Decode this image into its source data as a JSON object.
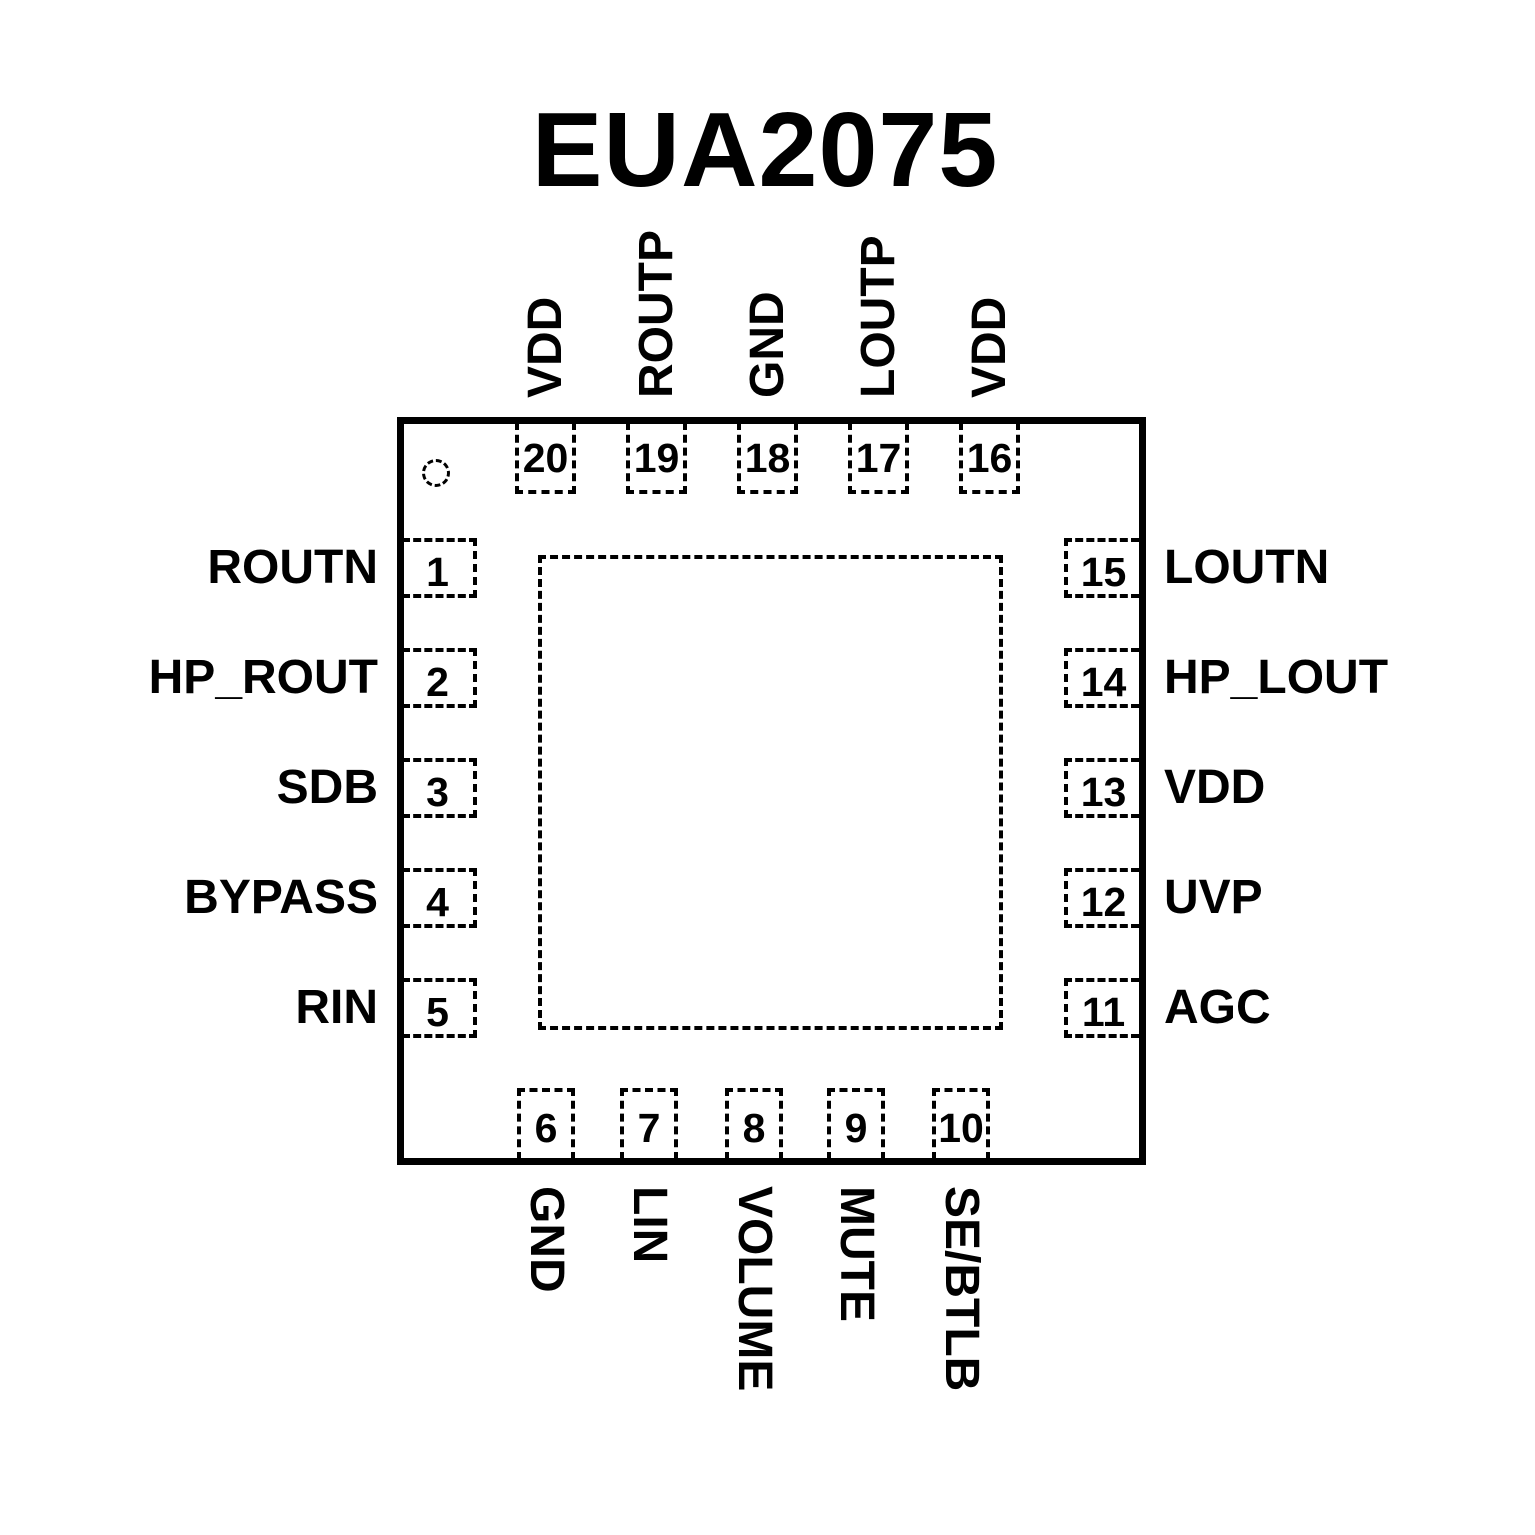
{
  "title": "EUA2075",
  "diagram_type": "ic-pinout",
  "colors": {
    "foreground": "#000000",
    "background": "#ffffff"
  },
  "pins": {
    "top": [
      {
        "number": "20",
        "label": "VDD"
      },
      {
        "number": "19",
        "label": "ROUTP"
      },
      {
        "number": "18",
        "label": "GND"
      },
      {
        "number": "17",
        "label": "LOUTP"
      },
      {
        "number": "16",
        "label": "VDD"
      }
    ],
    "left": [
      {
        "number": "1",
        "label": "ROUTN"
      },
      {
        "number": "2",
        "label": "HP_ROUT"
      },
      {
        "number": "3",
        "label": "SDB"
      },
      {
        "number": "4",
        "label": "BYPASS"
      },
      {
        "number": "5",
        "label": "RIN"
      }
    ],
    "right": [
      {
        "number": "15",
        "label": "LOUTN"
      },
      {
        "number": "14",
        "label": "HP_LOUT"
      },
      {
        "number": "13",
        "label": "VDD"
      },
      {
        "number": "12",
        "label": "UVP"
      },
      {
        "number": "11",
        "label": "AGC"
      }
    ],
    "bottom": [
      {
        "number": "6",
        "label": "GND"
      },
      {
        "number": "7",
        "label": "LIN"
      },
      {
        "number": "8",
        "label": "VOLUME"
      },
      {
        "number": "9",
        "label": "MUTE"
      },
      {
        "number": "10",
        "label": "SE/BTLB"
      }
    ]
  }
}
